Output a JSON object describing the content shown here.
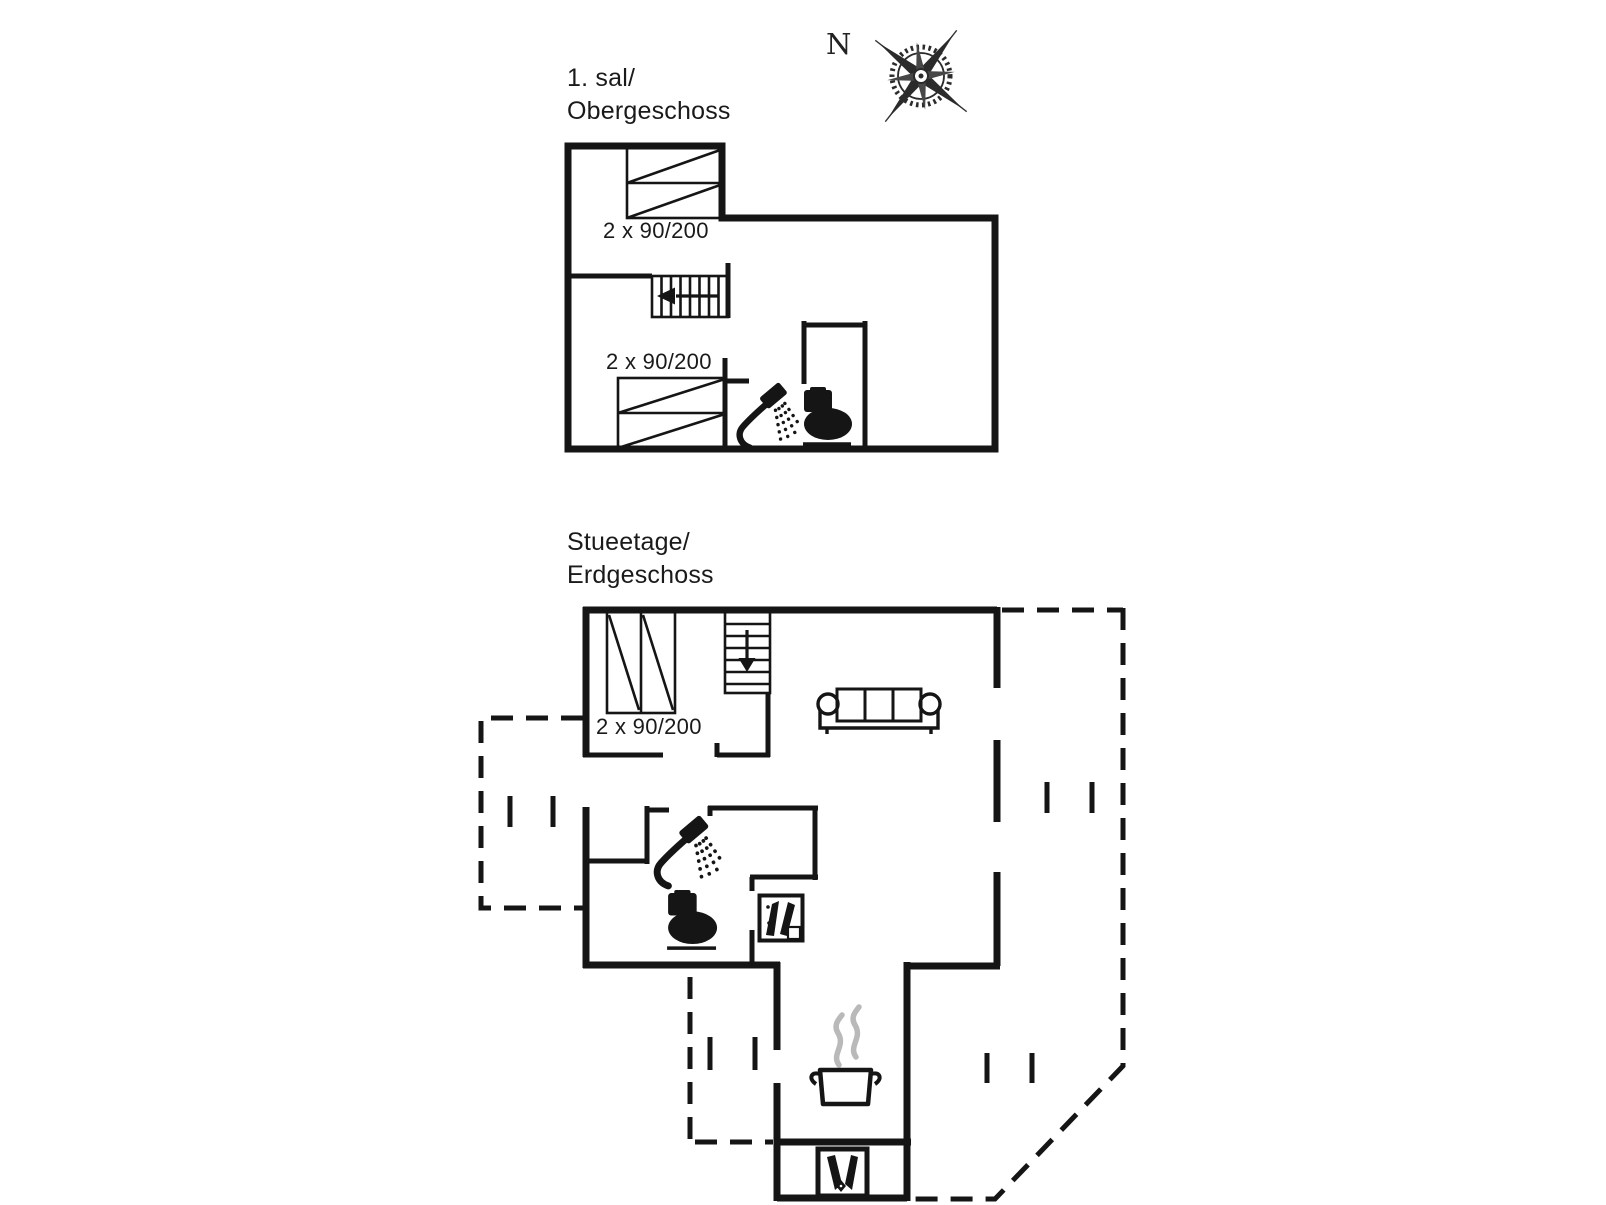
{
  "page": {
    "background": "#ffffff",
    "ink": "#151515",
    "steam_color": "#b9b9b9"
  },
  "compass": {
    "label": "N"
  },
  "upper_floor": {
    "title": "1. sal/\nObergeschoss",
    "bed_label_top": "2 x 90/200",
    "bed_label_bottom": "2 x 90/200"
  },
  "ground_floor": {
    "title": "Stueetage/\nErdgeschoss",
    "bed_label": "2 x 90/200"
  }
}
